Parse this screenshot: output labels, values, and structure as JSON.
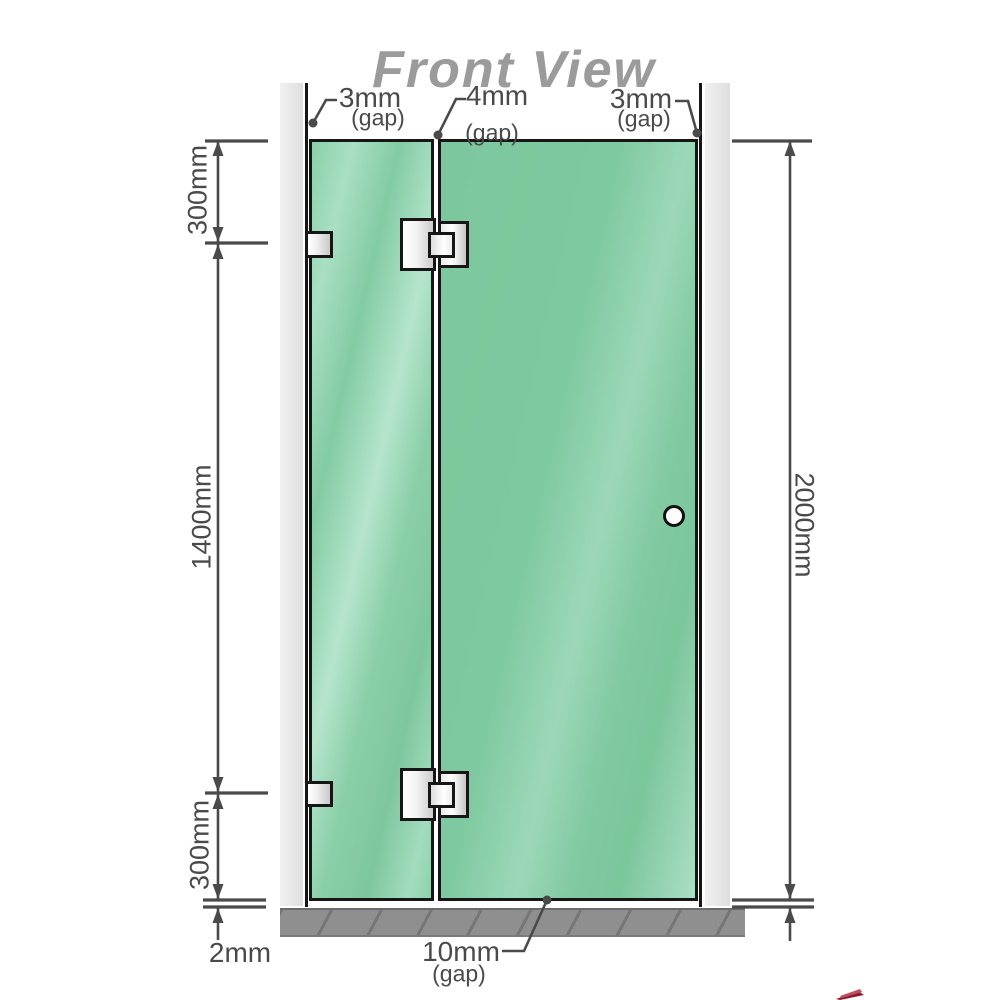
{
  "title": "Front View",
  "dimensions": {
    "gap_top_left": {
      "value": "3mm",
      "suffix": "(gap)"
    },
    "gap_middle": {
      "value": "4mm",
      "suffix": "(gap)"
    },
    "gap_top_right": {
      "value": "3mm",
      "suffix": "(gap)"
    },
    "gap_bottom": {
      "value": "10mm",
      "suffix": "(gap)"
    },
    "left_top_segment": "300mm",
    "left_middle_segment": "1400mm",
    "left_bottom_segment": "300mm",
    "right_total_height": "2000mm",
    "floor_clearance": "2mm"
  },
  "colors": {
    "glass_green": "#7cc89e",
    "glass_highlight": "#aadec4",
    "wall_channel_gray": "#e7e7e7",
    "floor_gray": "#8f8f8f",
    "dimension_gray": "#4a4a4a",
    "title_gray": "#9b9b9b",
    "hardware_silver": "#e8e8e8",
    "outline_black": "#161616",
    "watermark_red": "#8b1a2a"
  }
}
